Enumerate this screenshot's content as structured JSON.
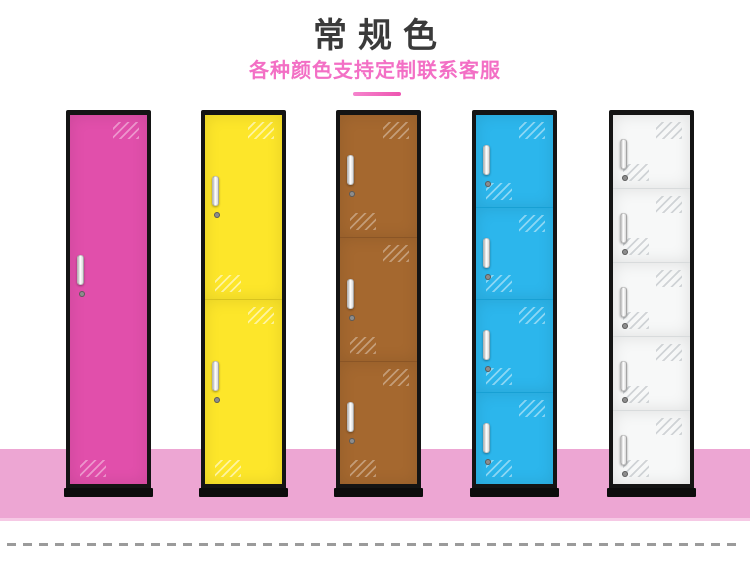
{
  "header": {
    "title": "常规色",
    "subtitle": "各种颜色支持定制联系客服",
    "title_color": "#3a3a3a",
    "subtitle_color": "#f36fc5",
    "divider_color": "#ee54b0"
  },
  "scene": {
    "floor_color": "#eda6d3",
    "frame_color": "#141414",
    "dashed_line_color": "#9b9b9b"
  },
  "lockers": [
    {
      "id": "pink",
      "doors": 1,
      "door_color": "#e14fab",
      "divider_color": "#c23b92",
      "shine_color": "rgba(255,255,255,0.40)"
    },
    {
      "id": "yellow",
      "doors": 2,
      "door_color": "#fde62a",
      "divider_color": "#d8c31d",
      "shine_color": "rgba(255,255,255,0.55)"
    },
    {
      "id": "brown",
      "doors": 3,
      "door_color": "#a5682f",
      "divider_color": "#8a5526",
      "shine_color": "rgba(255,255,255,0.35)"
    },
    {
      "id": "blue",
      "doors": 4,
      "door_color": "#2cb6ec",
      "divider_color": "#17a0d4",
      "shine_color": "rgba(255,255,255,0.45)"
    },
    {
      "id": "white",
      "doors": 5,
      "door_color": "#f7f8f8",
      "divider_color": "#d8dbdc",
      "shine_color": "rgba(175,181,186,0.55)"
    }
  ]
}
